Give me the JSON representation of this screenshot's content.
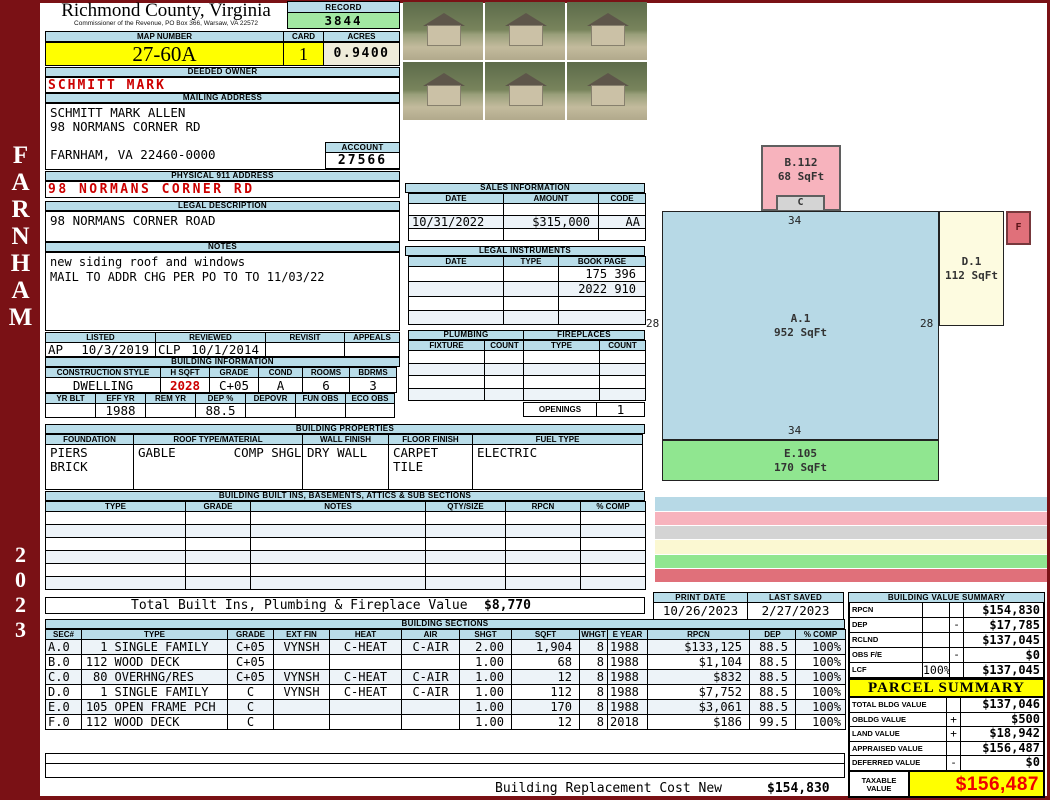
{
  "sidebar": {
    "district": "FARNHAM",
    "year": "2023"
  },
  "header": {
    "county": "Richmond County, Virginia",
    "commissioner_line": "Commissioner of the Revenue, PO Box 366, Warsaw, VA 22572",
    "record_label": "RECORD",
    "record_value": "3844",
    "map_number_label": "MAP NUMBER",
    "map_number": "27-60A",
    "card_label": "CARD",
    "card_value": "1",
    "acres_label": "ACRES",
    "acres_value": "0.9400"
  },
  "owner": {
    "deeded_owner_label": "DEEDED OWNER",
    "deeded_owner": "SCHMITT MARK",
    "mailing_address_label": "MAILING ADDRESS",
    "mailing_lines": [
      "SCHMITT MARK ALLEN",
      "98 NORMANS CORNER RD",
      "",
      "FARNHAM, VA 22460-0000"
    ],
    "account_label": "ACCOUNT",
    "account_value": "27566",
    "physical_address_label": "PHYSICAL 911 ADDRESS",
    "physical_address": "98 NORMANS CORNER RD",
    "legal_description_label": "LEGAL DESCRIPTION",
    "legal_description": "98 NORMANS CORNER ROAD",
    "notes_label": "NOTES",
    "notes_lines": [
      "new siding roof and windows",
      "MAIL TO ADDR CHG PER PO TO TO 11/03/22"
    ]
  },
  "visits": {
    "headers": [
      "LISTED",
      "REVIEWED",
      "REVISIT",
      "APPEALS"
    ],
    "listed_code": "AP",
    "listed_date": "10/3/2019",
    "reviewed_code": "CLP",
    "reviewed_date": "10/1/2014",
    "revisit": "",
    "appeals": ""
  },
  "building_information": {
    "title": "BUILDING INFORMATION",
    "row1_headers": [
      "CONSTRUCTION STYLE",
      "H SQFT",
      "GRADE",
      "COND",
      "ROOMS",
      "BDRMS"
    ],
    "row1_values": [
      "DWELLING",
      "2028",
      "C+05",
      "A",
      "6",
      "3"
    ],
    "row2_headers": [
      "YR BLT",
      "EFF YR",
      "REM YR",
      "DEP %",
      "DEPOVR",
      "FUN OBS",
      "ECO OBS"
    ],
    "row2_values": [
      "",
      "1988",
      "",
      "88.5",
      "",
      "",
      ""
    ]
  },
  "building_properties": {
    "title": "BUILDING PROPERTIES",
    "headers": [
      "FOUNDATION",
      "ROOF TYPE/MATERIAL",
      "WALL FINISH",
      "FLOOR FINISH",
      "FUEL TYPE"
    ],
    "foundation_lines": [
      "PIERS",
      "BRICK"
    ],
    "roof_type": "GABLE",
    "roof_material": "COMP SHGLS",
    "wall_finish": "DRY WALL",
    "floor_finish_lines": [
      "CARPET",
      "TILE"
    ],
    "fuel_type": "ELECTRIC"
  },
  "built_ins": {
    "title": "BUILDING BUILT INS, BASEMENTS, ATTICS & SUB SECTIONS",
    "headers": [
      "TYPE",
      "GRADE",
      "NOTES",
      "QTY/SIZE",
      "RPCN",
      "% COMP"
    ],
    "rows": [
      [
        "",
        "",
        "",
        "",
        "",
        ""
      ],
      [
        "",
        "",
        "",
        "",
        "",
        ""
      ],
      [
        "",
        "",
        "",
        "",
        "",
        ""
      ],
      [
        "",
        "",
        "",
        "",
        "",
        ""
      ],
      [
        "",
        "",
        "",
        "",
        "",
        ""
      ],
      [
        "",
        "",
        "",
        "",
        "",
        ""
      ]
    ]
  },
  "totals": {
    "built_ins_label": "Total Built Ins, Plumbing & Fireplace Value",
    "built_ins_value": "$8,770",
    "replacement_label": "Building Replacement Cost New",
    "replacement_value": "$154,830"
  },
  "sales": {
    "title": "SALES INFORMATION",
    "headers": [
      "DATE",
      "AMOUNT",
      "CODE"
    ],
    "rows": [
      {
        "date": "",
        "amount": "",
        "code": ""
      },
      {
        "date": "10/31/2022",
        "amount": "$315,000",
        "code": "AA"
      },
      {
        "date": "",
        "amount": "",
        "code": ""
      }
    ]
  },
  "legal_instruments": {
    "title": "LEGAL INSTRUMENTS",
    "headers": [
      "DATE",
      "TYPE",
      "BOOK PAGE"
    ],
    "rows": [
      {
        "date": "",
        "type": "D",
        "book": "175 396"
      },
      {
        "date": "10/31/2022",
        "type": "D",
        "book": "2022 910"
      },
      {
        "date": "",
        "type": "",
        "book": ""
      },
      {
        "date": "",
        "type": "",
        "book": ""
      }
    ]
  },
  "plumbing": {
    "title": "PLUMBING",
    "headers": [
      "FIXTURE",
      "COUNT"
    ],
    "rows": [
      {
        "fixture": "FULLBATH",
        "count": "2"
      },
      {
        "fixture": "",
        "count": ""
      },
      {
        "fixture": "",
        "count": ""
      },
      {
        "fixture": "",
        "count": ""
      }
    ]
  },
  "fireplaces": {
    "title": "FIREPLACES",
    "headers": [
      "TYPE",
      "COUNT"
    ],
    "rows": [
      {
        "type": "",
        "count": ""
      },
      {
        "type": "1ST MAS",
        "count": "1"
      },
      {
        "type": "",
        "count": ""
      },
      {
        "type": "",
        "count": ""
      }
    ],
    "openings_label": "OPENINGS",
    "openings_value": "1"
  },
  "building_sections": {
    "title": "BUILDING SECTIONS",
    "headers": [
      "SEC#",
      "TYPE",
      "GRADE",
      "EXT FIN",
      "HEAT",
      "AIR",
      "SHGT",
      "SQFT",
      "WHGT",
      "E YEAR",
      "RPCN",
      "DEP",
      "% COMP"
    ],
    "rows": [
      {
        "sec": "A.0",
        "qty": "1",
        "type": "SINGLE FAMILY",
        "grade": "C+05",
        "ext": "VYNSH",
        "heat": "C-HEAT",
        "air": "C-AIR",
        "shgt": "2.00",
        "sqft": "1,904",
        "whgt": "8",
        "eyear": "1988",
        "rpcn": "$133,125",
        "dep": "88.5",
        "comp": "100%"
      },
      {
        "sec": "B.0",
        "qty": "112",
        "type": "WOOD DECK",
        "grade": "C+05",
        "ext": "",
        "heat": "",
        "air": "",
        "shgt": "1.00",
        "sqft": "68",
        "whgt": "8",
        "eyear": "1988",
        "rpcn": "$1,104",
        "dep": "88.5",
        "comp": "100%"
      },
      {
        "sec": "C.0",
        "qty": "80",
        "type": "OVERHNG/RES",
        "grade": "C+05",
        "ext": "VYNSH",
        "heat": "C-HEAT",
        "air": "C-AIR",
        "shgt": "1.00",
        "sqft": "12",
        "whgt": "8",
        "eyear": "1988",
        "rpcn": "$832",
        "dep": "88.5",
        "comp": "100%"
      },
      {
        "sec": "D.0",
        "qty": "1",
        "type": "SINGLE FAMILY",
        "grade": "C",
        "ext": "VYNSH",
        "heat": "C-HEAT",
        "air": "C-AIR",
        "shgt": "1.00",
        "sqft": "112",
        "whgt": "8",
        "eyear": "1988",
        "rpcn": "$7,752",
        "dep": "88.5",
        "comp": "100%"
      },
      {
        "sec": "E.0",
        "qty": "105",
        "type": "OPEN FRAME PCH",
        "grade": "C",
        "ext": "",
        "heat": "",
        "air": "",
        "shgt": "1.00",
        "sqft": "170",
        "whgt": "8",
        "eyear": "1988",
        "rpcn": "$3,061",
        "dep": "88.5",
        "comp": "100%"
      },
      {
        "sec": "F.0",
        "qty": "112",
        "type": "WOOD DECK",
        "grade": "C",
        "ext": "",
        "heat": "",
        "air": "",
        "shgt": "1.00",
        "sqft": "12",
        "whgt": "8",
        "eyear": "2018",
        "rpcn": "$186",
        "dep": "99.5",
        "comp": "100%"
      }
    ]
  },
  "sketch": {
    "areas": [
      {
        "id": "A",
        "label": "A.1",
        "sqft": "952 SqFt",
        "color": "#b7d9e6"
      },
      {
        "id": "B",
        "label": "B.112",
        "sqft": "68 SqFt",
        "color": "#f7b3bd"
      },
      {
        "id": "C",
        "label": "C",
        "sqft": "",
        "color": "#d4d4d4"
      },
      {
        "id": "D",
        "label": "D.1",
        "sqft": "112 SqFt",
        "color": "#fdfbe0"
      },
      {
        "id": "E",
        "label": "E.105",
        "sqft": "170 SqFt",
        "color": "#90e690"
      },
      {
        "id": "F",
        "label": "F",
        "sqft": "",
        "color": "#e0707a"
      }
    ],
    "dimensions": {
      "top": "34",
      "left": "28",
      "right": "28",
      "bottom": "34"
    }
  },
  "sketch_legend": {
    "rows": [
      {
        "sec": "A.0",
        "qty": "1",
        "code": "SR34U28L34D28.",
        "color": "#b7d9e6"
      },
      {
        "sec": "B.0",
        "qty": "112",
        "code": "U28R12SU8R10D8L2U2L6D2L2.",
        "color": "#f7b3bd"
      },
      {
        "sec": "C.0",
        "qty": "80",
        "code": "U28R14SU2R6D2L6.",
        "color": "#d4d4d4"
      },
      {
        "sec": "D.0",
        "qty": "1",
        "code": "U28R34SR8D14L8U14.",
        "color": "#fbf8d2"
      },
      {
        "sec": "E.0",
        "qty": "105",
        "code": "U28R34D28SD5L34U5R34.",
        "color": "#90e690"
      },
      {
        "sec": "F.0",
        "qty": "112",
        "code": "U28R34R8SR3D4L3U4.",
        "color": "#e0707a"
      }
    ]
  },
  "dates": {
    "print_date_label": "PRINT DATE",
    "print_date": "10/26/2023",
    "last_saved_label": "LAST SAVED",
    "last_saved": "2/27/2023"
  },
  "building_value_summary": {
    "title": "BUILDING VALUE SUMMARY",
    "rows": [
      {
        "label": "RPCN",
        "pct": "",
        "op": "",
        "value": "$154,830"
      },
      {
        "label": "DEP",
        "pct": "",
        "op": "-",
        "value": "$17,785"
      },
      {
        "label": "RCLND",
        "pct": "",
        "op": "",
        "value": "$137,045"
      },
      {
        "label": "OBS F/E",
        "pct": "",
        "op": "-",
        "value": "$0"
      },
      {
        "label": "LCF",
        "pct": "100%",
        "op": "",
        "value": "$137,045"
      }
    ]
  },
  "parcel_summary": {
    "title": "PARCEL SUMMARY",
    "rows": [
      {
        "label": "TOTAL BLDG VALUE",
        "op": "",
        "value": "$137,046"
      },
      {
        "label": "OBLDG VALUE",
        "op": "+",
        "value": "$500"
      },
      {
        "label": "LAND VALUE",
        "op": "+",
        "value": "$18,942"
      },
      {
        "label": "APPRAISED VALUE",
        "op": "",
        "value": "$156,487"
      },
      {
        "label": "DEFERRED VALUE",
        "op": "-",
        "value": "$0"
      }
    ],
    "taxable_label": "TAXABLE VALUE",
    "taxable_value": "$156,487"
  },
  "photos": [
    "house-front",
    "tall-house-side",
    "storage-shed",
    "deck-closeup",
    "house-side-porch",
    "two-story-colonial"
  ],
  "colors": {
    "frame_maroon": "#7a1115",
    "header_blue": "#b9dde9",
    "highlight_yellow": "#ffff00",
    "record_green": "#a2e8a2",
    "alert_red": "#cc0000",
    "taxable_red": "#ee0000"
  }
}
